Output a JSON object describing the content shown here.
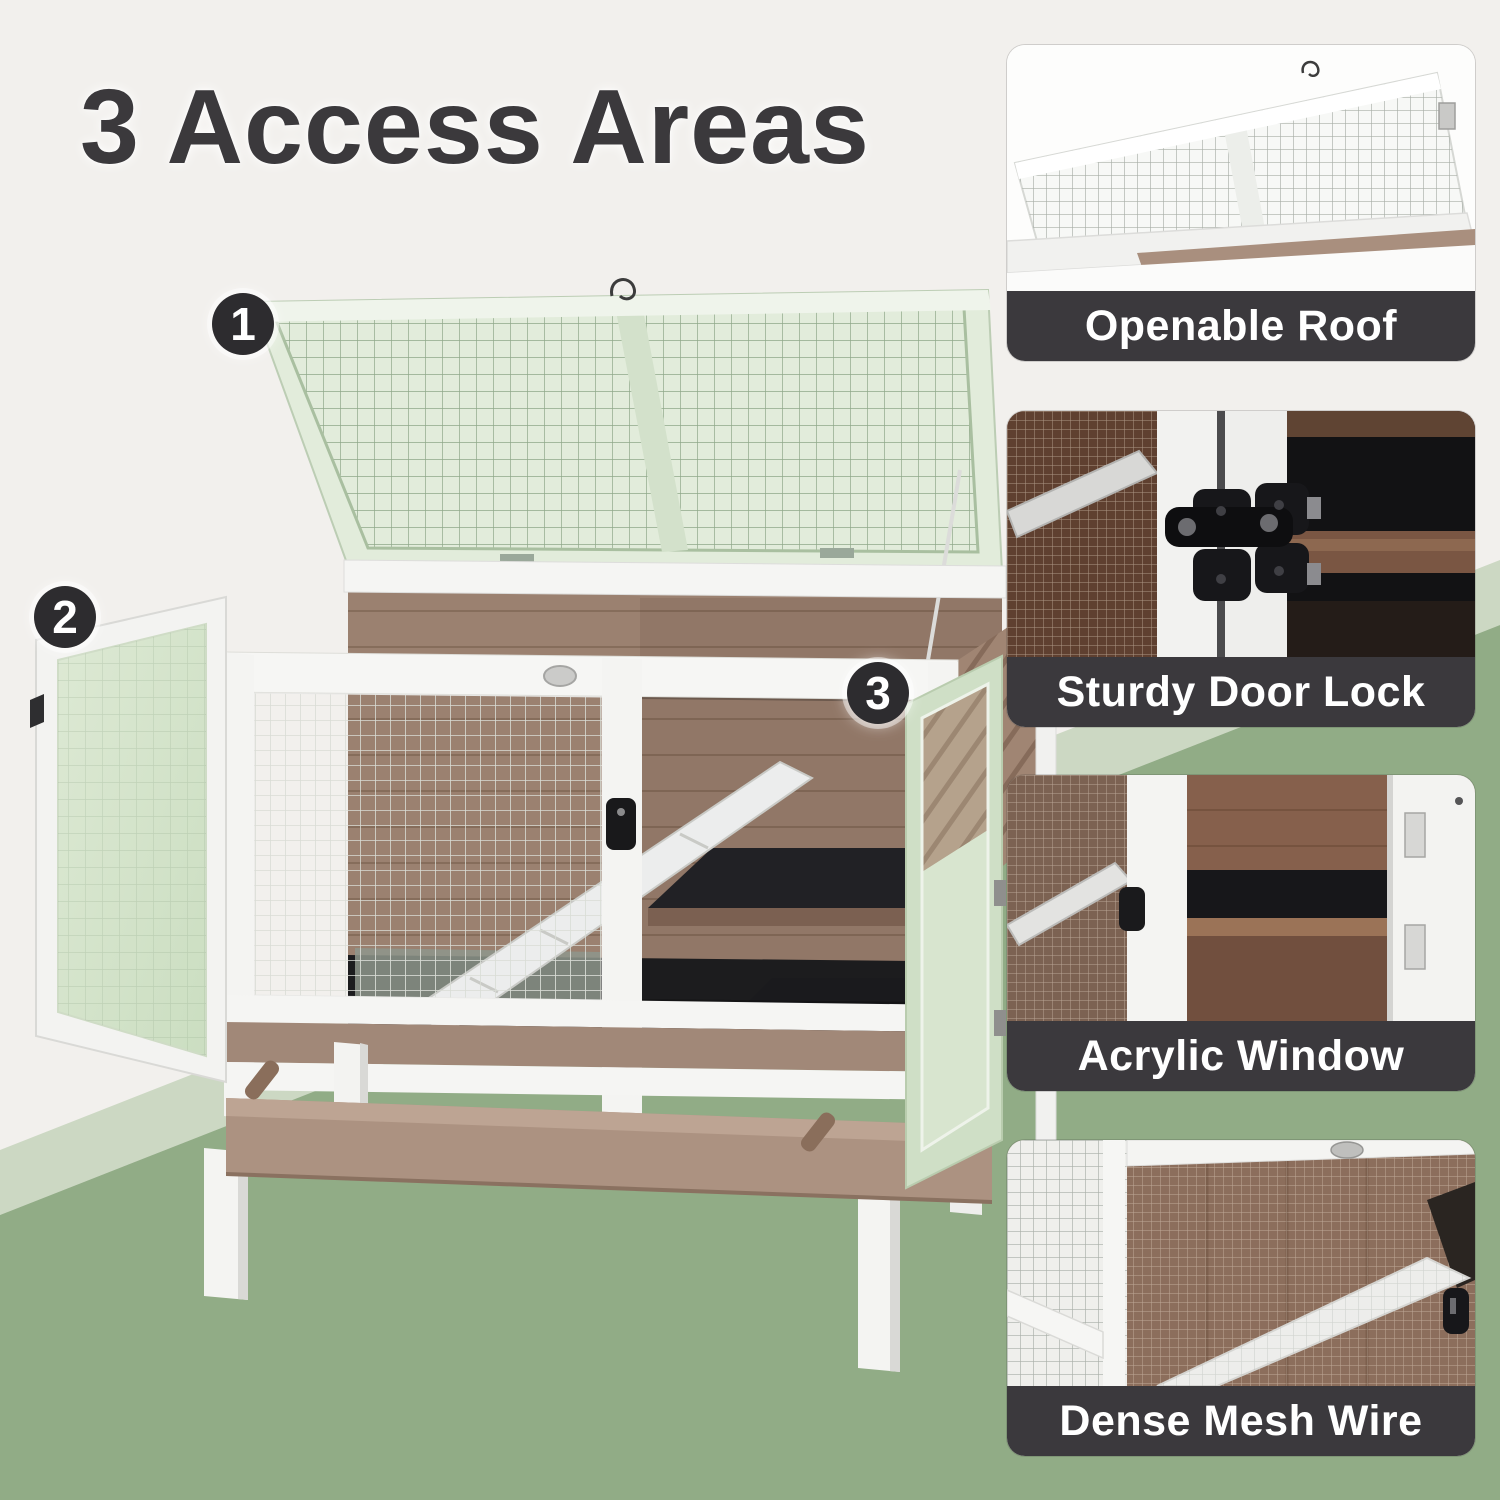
{
  "title": {
    "text": "3 Access Areas"
  },
  "badges": [
    {
      "number": "1"
    },
    {
      "number": "2"
    },
    {
      "number": "3"
    }
  ],
  "cards": [
    {
      "caption": "Openable Roof"
    },
    {
      "caption": "Sturdy Door Lock"
    },
    {
      "caption": "Acrylic Window"
    },
    {
      "caption": "Dense Mesh Wire"
    }
  ],
  "colors": {
    "background_white": "#f2f0ed",
    "background_light_green": "#ccd8c3",
    "background_green": "#91ac86",
    "caption_bar": "#3b393d",
    "caption_text": "#ffffff",
    "badge_bg": "#2d2c2f",
    "badge_text": "#ffffff",
    "title_text": "#3b393c",
    "wood_brown": "#9b8170",
    "tray_brown": "#ac9281",
    "frame_white": "#f5f5f3",
    "roof_mesh_green": "#e2ecdb",
    "door_acrylic_green": "#d6e3cd",
    "shelf_black": "#1d1d1f"
  }
}
